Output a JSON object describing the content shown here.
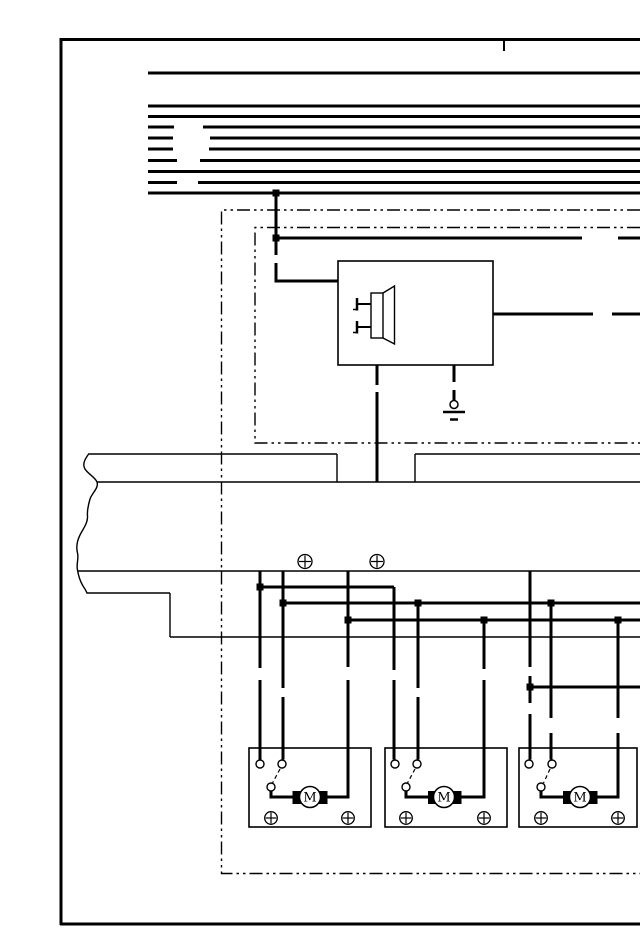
{
  "diagram": {
    "kind": "automotive wiring / door-lock actuator schematic",
    "background": "#ffffff",
    "ink": "#000000",
    "motor_label": "M",
    "lines": [
      {
        "n": "page-border-left",
        "p": [
          61,
          38,
          61,
          925
        ],
        "w": 3
      },
      {
        "n": "page-border-top",
        "p": [
          60,
          39.5,
          640,
          39.5
        ],
        "w": 3
      },
      {
        "n": "page-border-bottom",
        "p": [
          60,
          924,
          640,
          924
        ],
        "w": 3
      },
      {
        "n": "top-edge-tick",
        "p": [
          504,
          39,
          504,
          51
        ],
        "w": 2
      },
      {
        "n": "bus-line-1",
        "p": [
          148,
          73,
          640,
          73
        ],
        "w": 3
      },
      {
        "n": "bus-line-2",
        "p": [
          148,
          106,
          640,
          106
        ],
        "w": 3
      },
      {
        "n": "bus-line-3",
        "p": [
          148,
          116.5,
          640,
          116.5
        ],
        "w": 3
      },
      {
        "n": "bus-line-4a",
        "p": [
          148,
          127,
          174,
          127
        ],
        "w": 3
      },
      {
        "n": "bus-line-4b",
        "p": [
          203,
          127,
          640,
          127
        ],
        "w": 3
      },
      {
        "n": "bus-line-5a",
        "p": [
          148,
          138,
          173,
          138
        ],
        "w": 3
      },
      {
        "n": "bus-line-5b",
        "p": [
          210,
          138,
          640,
          138
        ],
        "w": 3
      },
      {
        "n": "bus-line-6a",
        "p": [
          148,
          149,
          173,
          149
        ],
        "w": 3
      },
      {
        "n": "bus-line-6b",
        "p": [
          209,
          149,
          640,
          149
        ],
        "w": 3
      },
      {
        "n": "bus-line-7a",
        "p": [
          148,
          160.5,
          177,
          160.5
        ],
        "w": 3
      },
      {
        "n": "bus-line-7b",
        "p": [
          200,
          160.5,
          640,
          160.5
        ],
        "w": 3
      },
      {
        "n": "bus-line-8",
        "p": [
          148,
          171.5,
          640,
          171.5
        ],
        "w": 3
      },
      {
        "n": "bus-line-9a",
        "p": [
          148,
          182.5,
          177,
          182.5
        ],
        "w": 3
      },
      {
        "n": "bus-line-9b",
        "p": [
          198,
          182.5,
          640,
          182.5
        ],
        "w": 3
      },
      {
        "n": "bus-line-10",
        "p": [
          148,
          193,
          640,
          193
        ],
        "w": 3
      },
      {
        "n": "feed-wire-vertical-upper",
        "p": [
          276,
          193,
          276,
          255
        ],
        "w": 3
      },
      {
        "n": "row1-wire-a",
        "p": [
          274.5,
          238,
          582,
          238
        ],
        "w": 3
      },
      {
        "n": "row1-wire-b",
        "p": [
          618,
          238,
          640,
          238
        ],
        "w": 3
      },
      {
        "n": "horn-output-wire-a",
        "p": [
          493,
          314,
          593,
          314
        ],
        "w": 3
      },
      {
        "n": "horn-output-wire-b",
        "p": [
          612,
          314,
          640,
          314
        ],
        "w": 3
      },
      {
        "n": "horn-down-wire-a",
        "p": [
          377,
          365,
          377,
          385
        ],
        "w": 3
      },
      {
        "n": "horn-down-wire-b",
        "p": [
          377,
          392,
          377,
          482
        ],
        "w": 3
      },
      {
        "n": "ground-wire-a",
        "p": [
          454,
          365,
          454,
          382
        ],
        "w": 3
      },
      {
        "n": "ground-wire-b",
        "p": [
          454,
          390,
          454,
          400
        ],
        "w": 3
      },
      {
        "n": "wire-v260-a",
        "p": [
          260,
          571,
          260,
          668
        ],
        "w": 3
      },
      {
        "n": "wire-v260-b",
        "p": [
          260,
          680,
          260,
          759.5
        ],
        "w": 3
      },
      {
        "n": "branch-h587",
        "p": [
          260,
          587,
          394,
          587
        ],
        "w": 3
      },
      {
        "n": "wire-v394-a",
        "p": [
          394,
          587,
          394,
          670
        ],
        "w": 3
      },
      {
        "n": "wire-v394-b",
        "p": [
          394,
          680,
          394,
          759.5
        ],
        "w": 3
      },
      {
        "n": "wire-v283-a",
        "p": [
          283,
          571,
          283,
          688
        ],
        "w": 3
      },
      {
        "n": "wire-v283-b",
        "p": [
          283,
          697,
          283,
          759.5
        ],
        "w": 3
      },
      {
        "n": "branch-h603",
        "p": [
          283,
          603,
          640,
          603
        ],
        "w": 3
      },
      {
        "n": "wire-v418-a",
        "p": [
          418,
          603,
          418,
          688
        ],
        "w": 3
      },
      {
        "n": "wire-v418-b",
        "p": [
          418,
          697,
          418,
          759.5
        ],
        "w": 3
      },
      {
        "n": "wire-v551-a",
        "p": [
          551,
          603,
          551,
          718
        ],
        "w": 3
      },
      {
        "n": "wire-v551-b",
        "p": [
          551,
          733,
          551,
          759.5
        ],
        "w": 3
      },
      {
        "n": "wire-v348-a",
        "p": [
          348,
          571,
          348,
          667
        ],
        "w": 3
      },
      {
        "n": "branch-h620",
        "p": [
          348,
          620,
          640,
          620
        ],
        "w": 3
      },
      {
        "n": "wire-v484-a",
        "p": [
          484,
          620,
          484,
          669
        ],
        "w": 3
      },
      {
        "n": "wire-v618-a",
        "p": [
          618,
          620,
          618,
          718
        ],
        "w": 3
      },
      {
        "n": "wire-v530-a",
        "p": [
          530,
          571,
          530,
          667
        ],
        "w": 3
      },
      {
        "n": "wire-v530-b",
        "p": [
          530,
          676,
          530,
          703
        ],
        "w": 3
      },
      {
        "n": "wire-v530-c",
        "p": [
          530,
          714,
          530,
          759.5
        ],
        "w": 3
      },
      {
        "n": "branch-h687",
        "p": [
          530,
          687,
          640,
          687
        ],
        "w": 3
      },
      {
        "n": "harness-top-edge-a",
        "p": [
          89,
          454,
          337,
          454
        ],
        "w": 1.4
      },
      {
        "n": "harness-top-edge-b",
        "p": [
          415,
          454,
          640,
          454
        ],
        "w": 1.4
      },
      {
        "n": "harness-notch-left",
        "p": [
          337,
          454,
          337,
          482
        ],
        "w": 1.4
      },
      {
        "n": "harness-notch-right",
        "p": [
          415,
          454,
          415,
          482
        ],
        "w": 1.4
      },
      {
        "n": "harness-band-bottom",
        "p": [
          97,
          482,
          640,
          482
        ],
        "w": 1.4
      },
      {
        "n": "harness-mid-edge",
        "p": [
          78,
          571,
          640,
          571
        ],
        "w": 1.4
      },
      {
        "n": "harness-lower-edge-a",
        "p": [
          87,
          593,
          170,
          593
        ],
        "w": 1.4
      },
      {
        "n": "harness-lower-step",
        "p": [
          170,
          593,
          170,
          637
        ],
        "w": 1.4
      },
      {
        "n": "harness-lower-edge-b",
        "p": [
          170,
          637,
          640,
          637
        ],
        "w": 1.4
      },
      {
        "n": "horn-pin1-lead",
        "p": [
          358,
          304,
          371,
          304
        ],
        "w": 2
      },
      {
        "n": "horn-pin1-bar",
        "p": [
          357,
          298,
          357,
          310.5
        ],
        "w": 2.5
      },
      {
        "n": "horn-pin1-foot",
        "p": [
          353,
          309.5,
          357.5,
          309.5
        ],
        "w": 1.5
      },
      {
        "n": "horn-pin2-lead",
        "p": [
          358,
          327,
          371,
          327
        ],
        "w": 2
      },
      {
        "n": "horn-pin2-bar",
        "p": [
          357,
          321,
          357,
          333.5
        ],
        "w": 2.5
      },
      {
        "n": "horn-pin2-foot",
        "p": [
          353,
          332.5,
          357.5,
          332.5
        ],
        "w": 1.5
      },
      {
        "n": "ground-bar-long",
        "p": [
          443,
          412,
          465,
          412
        ],
        "w": 2.5
      },
      {
        "n": "ground-bar-short",
        "p": [
          450,
          419.5,
          458,
          419.5
        ],
        "w": 2.5
      },
      {
        "n": "switch-throw-1",
        "p": [
          280,
          769,
          272.5,
          783
        ],
        "w": 1.2,
        "dash": "4 3"
      },
      {
        "n": "switch-throw-2",
        "p": [
          415,
          769,
          407.5,
          783
        ],
        "w": 1.2,
        "dash": "4 3"
      },
      {
        "n": "switch-throw-3",
        "p": [
          550,
          769,
          543.5,
          783
        ],
        "w": 1.2,
        "dash": "4 3"
      }
    ],
    "polylines": [
      {
        "n": "component-boundary-outer",
        "pts": [
          [
            640,
            210
          ],
          [
            221.5,
            210
          ],
          [
            221.5,
            873.5
          ],
          [
            640,
            873.5
          ]
        ],
        "w": 1.4,
        "dash": "13 4 2.5 4 2.5 4"
      },
      {
        "n": "component-boundary-inner",
        "pts": [
          [
            640,
            227.5
          ],
          [
            255,
            227.5
          ],
          [
            255,
            443
          ],
          [
            640,
            443
          ]
        ],
        "w": 1.4,
        "dash": "13 4 2.5 4 2.5 4"
      },
      {
        "n": "feed-wire-into-horn-box",
        "pts": [
          [
            276,
            263
          ],
          [
            276,
            281
          ],
          [
            338,
            281
          ]
        ],
        "w": 3
      },
      {
        "n": "motor1-right-wire",
        "pts": [
          [
            348,
            680
          ],
          [
            348,
            797
          ],
          [
            327.5,
            797
          ]
        ],
        "w": 3
      },
      {
        "n": "motor2-right-wire",
        "pts": [
          [
            484,
            680
          ],
          [
            484,
            797
          ],
          [
            461.5,
            797
          ]
        ],
        "w": 3
      },
      {
        "n": "motor3-right-wire",
        "pts": [
          [
            618,
            733
          ],
          [
            618,
            797
          ],
          [
            597.5,
            797
          ]
        ],
        "w": 3
      },
      {
        "n": "switch1-to-motor-wire",
        "pts": [
          [
            271,
            790
          ],
          [
            271,
            797
          ],
          [
            292.5,
            797
          ]
        ],
        "w": 3
      },
      {
        "n": "switch2-to-motor-wire",
        "pts": [
          [
            406,
            790
          ],
          [
            406,
            797
          ],
          [
            428,
            797
          ]
        ],
        "w": 3
      },
      {
        "n": "switch3-to-motor-wire",
        "pts": [
          [
            541,
            790
          ],
          [
            541,
            797
          ],
          [
            563,
            797
          ]
        ],
        "w": 3
      }
    ],
    "paths": [
      {
        "n": "harness-torn-edge",
        "d": "M 89 453.5 C 85 459 82 464 85 469 C 88 474 95 477 97 482 C 99 488 92 493 90 499 C 88 506 87 511 87.5 516 C 88 523 83 529 80 535 C 77 541 76 547 77.5 553 C 79 559 76 564 77.5 570 C 78.5 576 80 581 83 586 C 85 589 86.5 591 87 593.5",
        "w": 1.4
      },
      {
        "n": "horn-cone",
        "d": "M 383 293 L 394.5 286 L 394.5 344 L 383 338",
        "w": 1.4
      }
    ],
    "rects": [
      {
        "n": "horn-relay-box",
        "x": 338,
        "y": 261,
        "w": 155,
        "h": 104,
        "sw": 1.6
      },
      {
        "n": "horn-body",
        "x": 371,
        "y": 293,
        "w": 12,
        "h": 45,
        "sw": 1.4
      },
      {
        "n": "actuator-box-1",
        "x": 249,
        "y": 748,
        "w": 122,
        "h": 79,
        "sw": 1.6
      },
      {
        "n": "actuator-box-2",
        "x": 385,
        "y": 748,
        "w": 122,
        "h": 79,
        "sw": 1.6
      },
      {
        "n": "actuator-box-3",
        "x": 519,
        "y": 748,
        "w": 118,
        "h": 79,
        "sw": 1.6
      },
      {
        "n": "motor1-brush-left",
        "x": 292.5,
        "y": 791,
        "w": 9,
        "h": 13,
        "fill": true
      },
      {
        "n": "motor1-brush-right",
        "x": 318.5,
        "y": 791,
        "w": 9,
        "h": 13,
        "fill": true
      },
      {
        "n": "motor2-brush-left",
        "x": 428,
        "y": 791,
        "w": 9,
        "h": 13,
        "fill": true
      },
      {
        "n": "motor2-brush-right",
        "x": 452.5,
        "y": 791,
        "w": 9,
        "h": 13,
        "fill": true
      },
      {
        "n": "motor3-brush-left",
        "x": 563,
        "y": 791,
        "w": 9,
        "h": 13,
        "fill": true
      },
      {
        "n": "motor3-brush-right",
        "x": 588.5,
        "y": 791,
        "w": 9,
        "h": 13,
        "fill": true
      }
    ],
    "circles": [
      {
        "n": "ground-ring",
        "cx": 454,
        "cy": 404.5,
        "r": 4,
        "sw": 1.5
      },
      {
        "n": "screw-harness-1",
        "cx": 305,
        "cy": 561.5,
        "r": 7,
        "sw": 1.3,
        "cross": true
      },
      {
        "n": "screw-harness-2",
        "cx": 377,
        "cy": 561.5,
        "r": 7,
        "sw": 1.3,
        "cross": true
      },
      {
        "n": "terminal-1a",
        "cx": 260,
        "cy": 764,
        "r": 4,
        "sw": 1.4
      },
      {
        "n": "terminal-1b",
        "cx": 282,
        "cy": 764,
        "r": 4,
        "sw": 1.4
      },
      {
        "n": "switch-pivot-1",
        "cx": 271,
        "cy": 787,
        "r": 4,
        "sw": 1.4
      },
      {
        "n": "terminal-2a",
        "cx": 395,
        "cy": 764,
        "r": 4,
        "sw": 1.4
      },
      {
        "n": "terminal-2b",
        "cx": 417,
        "cy": 764,
        "r": 4,
        "sw": 1.4
      },
      {
        "n": "switch-pivot-2",
        "cx": 406,
        "cy": 787,
        "r": 4,
        "sw": 1.4
      },
      {
        "n": "terminal-3a",
        "cx": 529,
        "cy": 764,
        "r": 4,
        "sw": 1.4
      },
      {
        "n": "terminal-3b",
        "cx": 552,
        "cy": 764,
        "r": 4,
        "sw": 1.4
      },
      {
        "n": "switch-pivot-3",
        "cx": 541,
        "cy": 787,
        "r": 4,
        "sw": 1.4
      },
      {
        "n": "motor1-circle",
        "cx": 310,
        "cy": 797,
        "r": 10.5,
        "sw": 1.5
      },
      {
        "n": "motor2-circle",
        "cx": 444,
        "cy": 797,
        "r": 10.5,
        "sw": 1.5
      },
      {
        "n": "motor3-circle",
        "cx": 580,
        "cy": 797,
        "r": 10.5,
        "sw": 1.5
      },
      {
        "n": "screw-box1-left",
        "cx": 271,
        "cy": 818,
        "r": 6.3,
        "sw": 1.3,
        "cross": true
      },
      {
        "n": "screw-box1-right",
        "cx": 348,
        "cy": 818,
        "r": 6.3,
        "sw": 1.3,
        "cross": true
      },
      {
        "n": "screw-box2-left",
        "cx": 406,
        "cy": 818,
        "r": 6.3,
        "sw": 1.3,
        "cross": true
      },
      {
        "n": "screw-box2-right",
        "cx": 484,
        "cy": 818,
        "r": 6.3,
        "sw": 1.3,
        "cross": true
      },
      {
        "n": "screw-box3-left",
        "cx": 541,
        "cy": 818,
        "r": 6.3,
        "sw": 1.3,
        "cross": true
      },
      {
        "n": "screw-box3-right",
        "cx": 618,
        "cy": 818,
        "r": 6.3,
        "sw": 1.3,
        "cross": true
      }
    ],
    "dots": [
      {
        "n": "junction-bus-feed",
        "x": 276,
        "y": 193,
        "s": 7
      },
      {
        "n": "junction-row1",
        "x": 276,
        "y": 238,
        "s": 7
      },
      {
        "n": "junction-587",
        "x": 260,
        "y": 587,
        "s": 7
      },
      {
        "n": "junction-603-a",
        "x": 283,
        "y": 603,
        "s": 7
      },
      {
        "n": "junction-603-b",
        "x": 418,
        "y": 603,
        "s": 7
      },
      {
        "n": "junction-603-c",
        "x": 551,
        "y": 603,
        "s": 7
      },
      {
        "n": "junction-620-a",
        "x": 348,
        "y": 620,
        "s": 7
      },
      {
        "n": "junction-620-b",
        "x": 484,
        "y": 620,
        "s": 7
      },
      {
        "n": "junction-620-c",
        "x": 618,
        "y": 620,
        "s": 7
      },
      {
        "n": "junction-687",
        "x": 530,
        "y": 687,
        "s": 7
      }
    ],
    "texts": [
      {
        "n": "motor1-label",
        "x": 310,
        "y": 801.5,
        "t": "M",
        "size": 13
      },
      {
        "n": "motor2-label",
        "x": 444,
        "y": 801.5,
        "t": "M",
        "size": 13
      },
      {
        "n": "motor3-label",
        "x": 580,
        "y": 801.5,
        "t": "M",
        "size": 13
      }
    ]
  }
}
